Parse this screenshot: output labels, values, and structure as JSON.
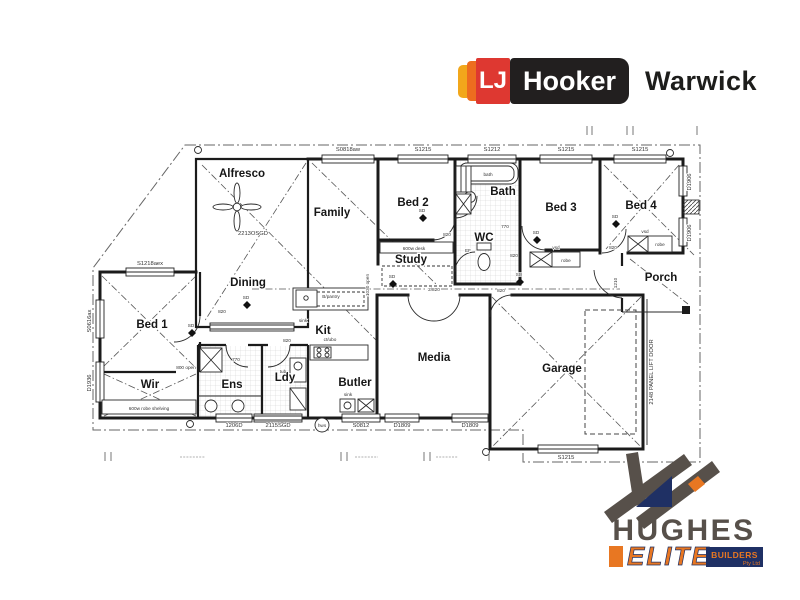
{
  "colors": {
    "lj_yellow": "#F2A71B",
    "lj_orange": "#ED6D1F",
    "lj_red": "#DE3831",
    "lj_dark": "#221F1F",
    "hughes_orange": "#E87722",
    "hughes_navy": "#1F3064",
    "hughes_gray": "#57504A"
  },
  "header": {
    "lj": "LJ",
    "hooker": "Hooker",
    "office": "Warwick"
  },
  "builder": {
    "name": "HUGHES",
    "elite": "ELITE",
    "builders": "BUILDERS",
    "pty": "Pty Ltd"
  },
  "plan": {
    "rooms": {
      "alfresco": "Alfresco",
      "family": "Family",
      "bed2": "Bed 2",
      "study": "Study",
      "bath": "Bath",
      "wc": "WC",
      "bed3": "Bed 3",
      "bed4": "Bed 4",
      "porch": "Porch",
      "dining": "Dining",
      "bed1": "Bed 1",
      "wir": "Wir",
      "ens": "Ens",
      "ldy": "Ldy",
      "kit": "Kit",
      "butler": "Butler",
      "media": "Media",
      "garage": "Garage"
    },
    "codes": {
      "s0818aw": "S0818aw",
      "s1215": "S1215",
      "s1212": "S1212",
      "s1218": "S1218aex",
      "s0616": "S0616ax",
      "d1936": "D1936",
      "d1906": "D1906",
      "s0812": "S0812",
      "d1809": "D1809",
      "w1206": "1206D",
      "sgd2115": "2115SGD",
      "osgd2213": "2213OSGD",
      "panel": "2148 PANEL LIFT DOOR"
    },
    "fixtures": {
      "bath": "bath",
      "tub": "tub",
      "sink": "sink",
      "hws": "hws",
      "robe": "robe",
      "vsd": "vsd",
      "bpantry": "B/pantry",
      "desk": "600w desk",
      "shelving": "600w robe shelving",
      "ctubo": "ct/ubo",
      "ef": "EF"
    },
    "dims": {
      "d770": "770",
      "d820": "820",
      "d2820": "2/820",
      "open800": "800 open",
      "open1030": "1030 open",
      "e1210": "1210",
      "sd": "SD"
    }
  }
}
